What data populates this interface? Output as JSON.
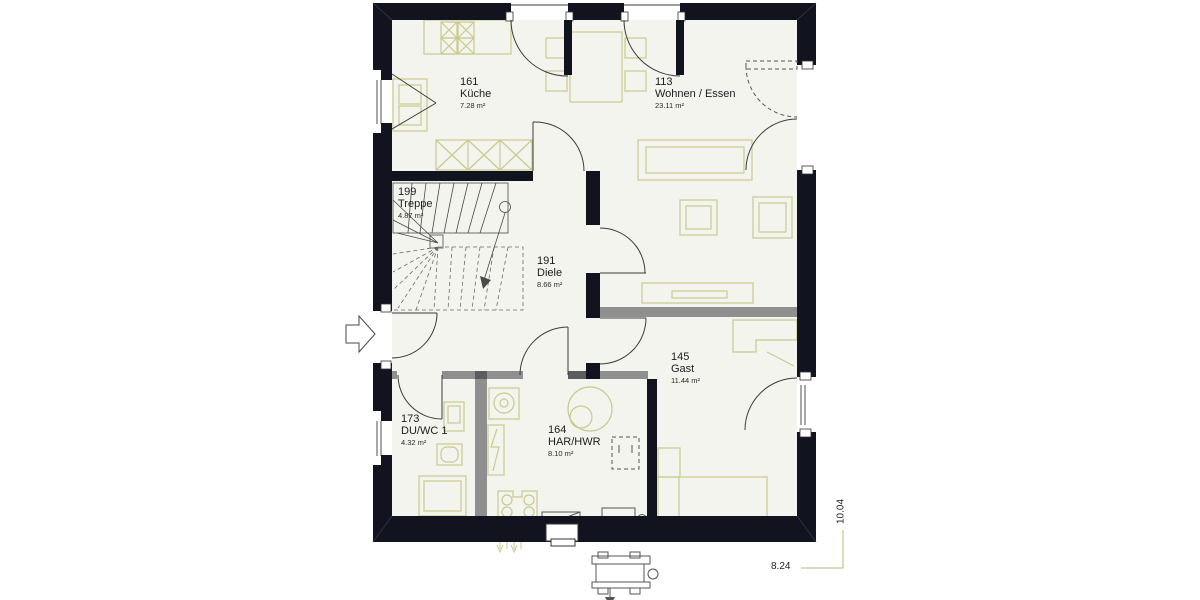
{
  "plan": {
    "rooms": [
      {
        "number": "161",
        "name": "Küche",
        "area": "7.28 m²"
      },
      {
        "number": "113",
        "name": "Wohnen / Essen",
        "area": "23.11 m²"
      },
      {
        "number": "199",
        "name": "Treppe",
        "area": "4.87 m²"
      },
      {
        "number": "191",
        "name": "Diele",
        "area": "8.66 m²"
      },
      {
        "number": "145",
        "name": "Gast",
        "area": "11.44 m²"
      },
      {
        "number": "173",
        "name": "DU/WC 1",
        "area": "4.32 m²"
      },
      {
        "number": "164",
        "name": "HAR/HWR",
        "area": "8.10 m²"
      }
    ],
    "dimensions": {
      "width_m": "8.24",
      "depth_m": "10.04"
    },
    "colors": {
      "wall": "#11141f",
      "partition": "#8f8f8f",
      "furniture": "#c8ca8e",
      "floor": "#f4f4ef",
      "dimline": "#b9b96e"
    }
  }
}
